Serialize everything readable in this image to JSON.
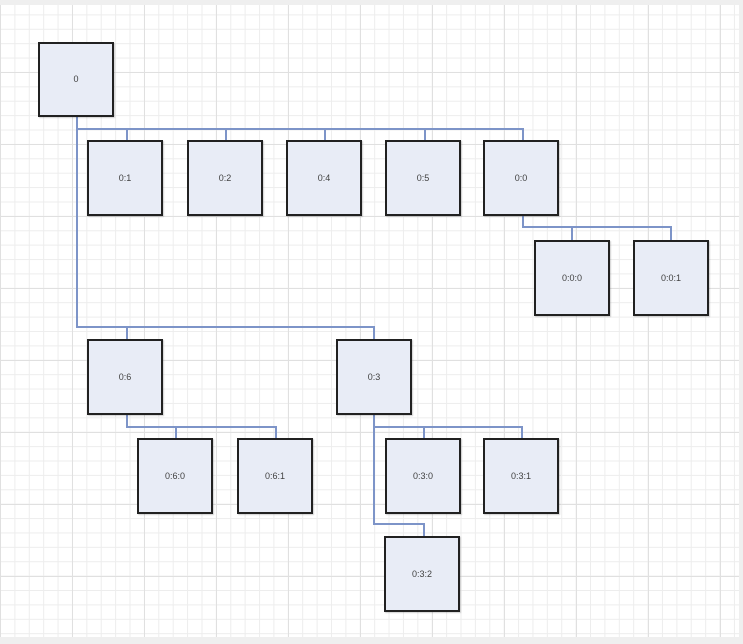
{
  "diagram": {
    "kind": "tree-diagram-on-grid-canvas",
    "colors": {
      "canvas_bg": "#ffffff",
      "grid_minor": "#ededed",
      "grid_major": "#e0e0e0",
      "frame_bg": "#efefef",
      "node_fill": "#e8ecf6",
      "node_border": "#212121",
      "edge_color": "#7d94c8",
      "label_color": "#404040"
    },
    "nodes": [
      {
        "label": "0"
      },
      {
        "label": "0:1"
      },
      {
        "label": "0:2"
      },
      {
        "label": "0:4"
      },
      {
        "label": "0:5"
      },
      {
        "label": "0:0"
      },
      {
        "label": "0:0:0"
      },
      {
        "label": "0:0:1"
      },
      {
        "label": "0:6"
      },
      {
        "label": "0:3"
      },
      {
        "label": "0:6:0"
      },
      {
        "label": "0:6:1"
      },
      {
        "label": "0:3:0"
      },
      {
        "label": "0:3:1"
      },
      {
        "label": "0:3:2"
      }
    ],
    "edges": [
      {
        "from": "0",
        "to": "0:1"
      },
      {
        "from": "0",
        "to": "0:2"
      },
      {
        "from": "0",
        "to": "0:4"
      },
      {
        "from": "0",
        "to": "0:5"
      },
      {
        "from": "0",
        "to": "0:0"
      },
      {
        "from": "0",
        "to": "0:6"
      },
      {
        "from": "0",
        "to": "0:3"
      },
      {
        "from": "0:0",
        "to": "0:0:0"
      },
      {
        "from": "0:0",
        "to": "0:0:1"
      },
      {
        "from": "0:6",
        "to": "0:6:0"
      },
      {
        "from": "0:6",
        "to": "0:6:1"
      },
      {
        "from": "0:3",
        "to": "0:3:0"
      },
      {
        "from": "0:3",
        "to": "0:3:1"
      },
      {
        "from": "0:3",
        "to": "0:3:2"
      }
    ]
  }
}
